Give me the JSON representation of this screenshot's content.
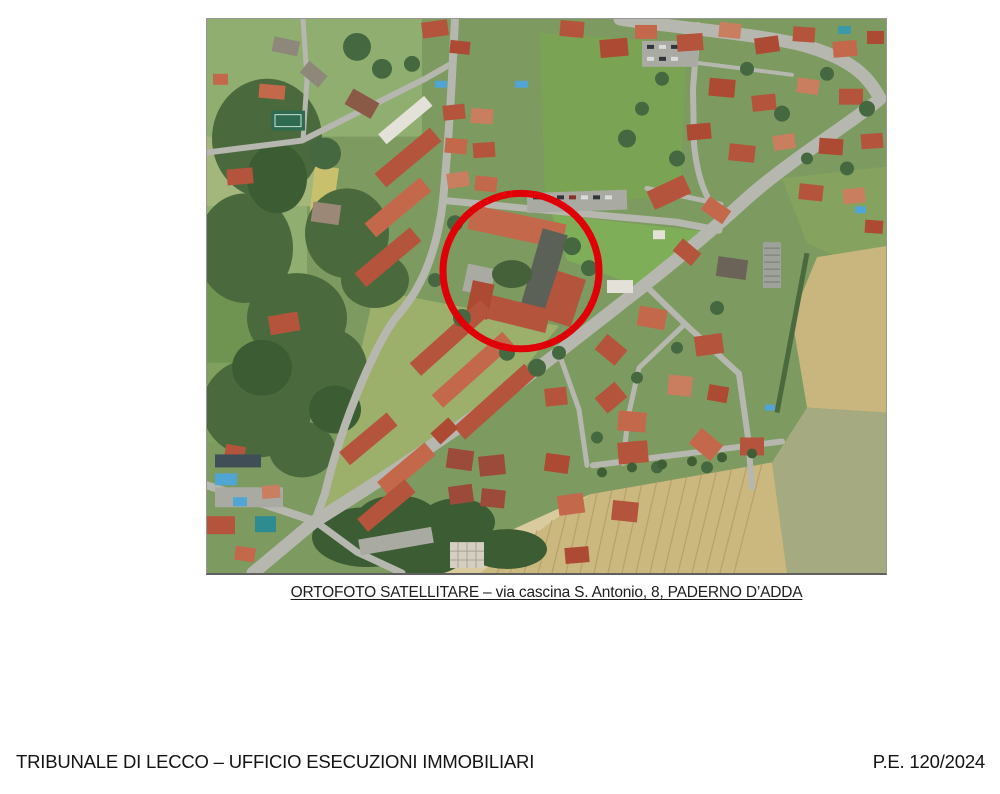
{
  "page": {
    "caption": "ORTOFOTO SATELLITARE – via cascina S. Antonio, 8, PADERNO D’ADDA",
    "footer_left": "TRIBUNALE DI LECCO – UFFICIO ESECUZIONI IMMOBILIARI",
    "footer_right": "P.E. 120/2024"
  },
  "map": {
    "highlight_color": "#e00008"
  }
}
